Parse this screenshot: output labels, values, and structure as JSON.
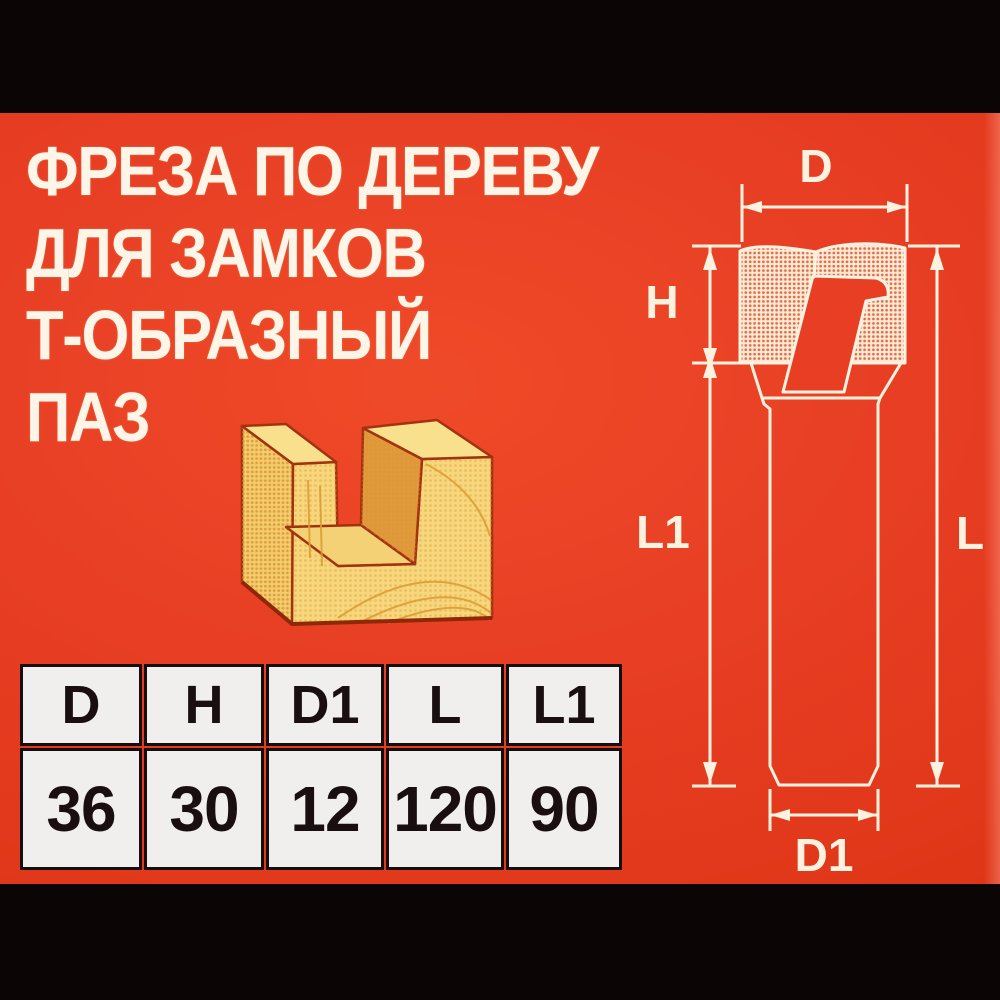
{
  "title": {
    "lines": [
      "ФРЕЗА ПО ДЕРЕВУ",
      "ДЛЯ ЗАМКОВ",
      "Т-ОБРАЗНЫЙ",
      "ПАЗ"
    ]
  },
  "spec_table": {
    "headers": [
      "D",
      "H",
      "D1",
      "L",
      "L1"
    ],
    "values": [
      "36",
      "30",
      "12",
      "120",
      "90"
    ]
  },
  "diagram": {
    "labels": {
      "d": "D",
      "h": "H",
      "l1": "L1",
      "l": "L",
      "d1": "D1"
    }
  },
  "illustrations": {
    "wood_block": "wooden block with U-shaped T-slot groove",
    "router_bit": "T-slot router bit side view with dimension arrows"
  },
  "colors": {
    "background_red": "#e73e24",
    "letterbox_black": "#0b0506",
    "title_white": "#fcf5e8",
    "diagram_line_cream": "#fdf2e0",
    "table_cell_white": "#f1efed",
    "table_border_black": "#150d0e",
    "wood_light": "#f7da85",
    "wood_dark_face": "#e09a3c",
    "wood_outline": "#a23210"
  }
}
